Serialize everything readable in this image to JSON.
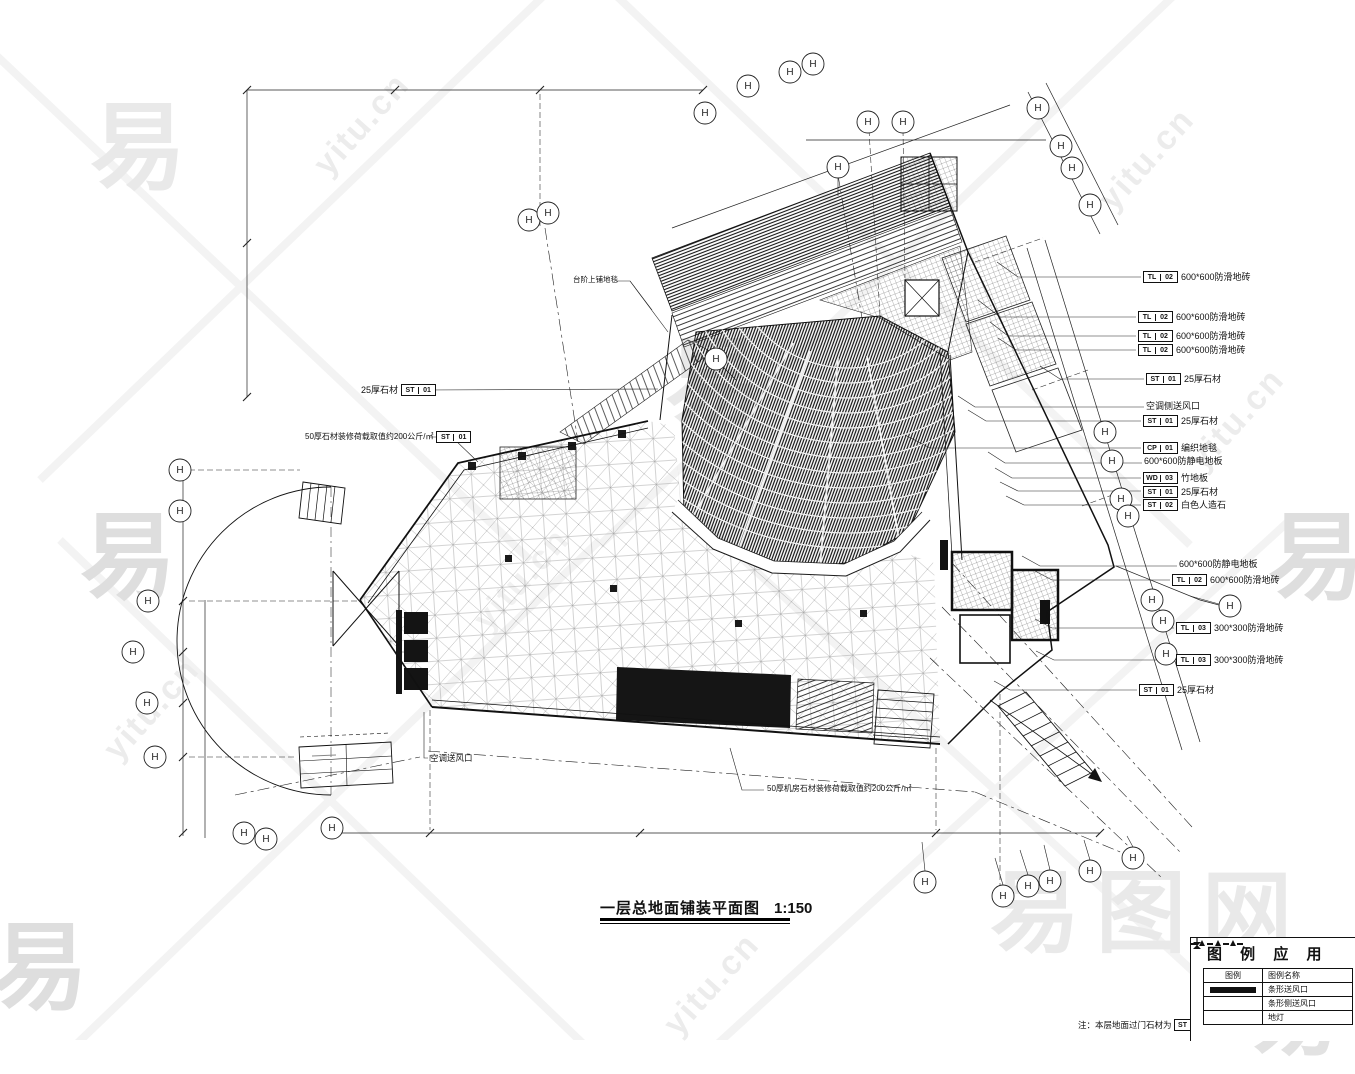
{
  "watermark": {
    "logo_char": "易",
    "site": "yitu.cn",
    "brand": "易图网"
  },
  "title": {
    "text": "一层总地面铺装平面图",
    "scale": "1:150"
  },
  "note": {
    "label": "注：本层地面过门石材为",
    "tag": [
      "ST",
      "01"
    ],
    "suffix": "。"
  },
  "legend": {
    "title": "图 例 应 用",
    "headers": [
      "图例",
      "图例名称"
    ],
    "rows": [
      {
        "symbol": "strip-supply-air-outlet",
        "name": "条形送风口"
      },
      {
        "symbol": "strip-side-supply-air-outlet",
        "name": "条形侧送风口"
      },
      {
        "symbol": "floor-lamp",
        "name": "地灯"
      }
    ]
  },
  "grid": {
    "bubble_glyph": "H"
  },
  "callouts": {
    "right": [
      {
        "tag": [
          "TL",
          "02"
        ],
        "text": "600*600防滑地砖"
      },
      {
        "tag": [
          "TL",
          "02"
        ],
        "text": "600*600防滑地砖"
      },
      {
        "tag": [
          "TL",
          "02"
        ],
        "text": "600*600防滑地砖"
      },
      {
        "tag": [
          "TL",
          "02"
        ],
        "text": "600*600防滑地砖"
      },
      {
        "tag": [
          "ST",
          "01"
        ],
        "text": "25厚石材"
      },
      {
        "tag": null,
        "text": "空调侧送风口"
      },
      {
        "tag": [
          "ST",
          "01"
        ],
        "text": "25厚石材"
      },
      {
        "tag": [
          "CP",
          "01"
        ],
        "text": "编织地毯"
      },
      {
        "tag": null,
        "text": "600*600防静电地板"
      },
      {
        "tag": [
          "WD",
          "03"
        ],
        "text": "竹地板"
      },
      {
        "tag": [
          "ST",
          "01"
        ],
        "text": "25厚石材"
      },
      {
        "tag": [
          "ST",
          "02"
        ],
        "text": "白色人造石"
      },
      {
        "tag": null,
        "text": "600*600防静电地板"
      },
      {
        "tag": [
          "TL",
          "02"
        ],
        "text": "600*600防滑地砖"
      },
      {
        "tag": [
          "TL",
          "03"
        ],
        "text": "300*300防滑地砖"
      },
      {
        "tag": [
          "TL",
          "03"
        ],
        "text": "300*300防滑地砖"
      },
      {
        "tag": [
          "ST",
          "01"
        ],
        "text": "25厚石材"
      }
    ],
    "left": [
      {
        "text": "25厚石材",
        "tag": [
          "ST",
          "01"
        ]
      },
      {
        "text": "50厚石材装修荷载取值约200公斤/㎡",
        "tag": [
          "ST",
          "01"
        ]
      }
    ],
    "plan": [
      {
        "text": "台阶上铺地毯"
      },
      {
        "text": "空调送风口"
      },
      {
        "text": "50厚机房石材装修荷载取值约200公斤/㎡"
      }
    ]
  }
}
